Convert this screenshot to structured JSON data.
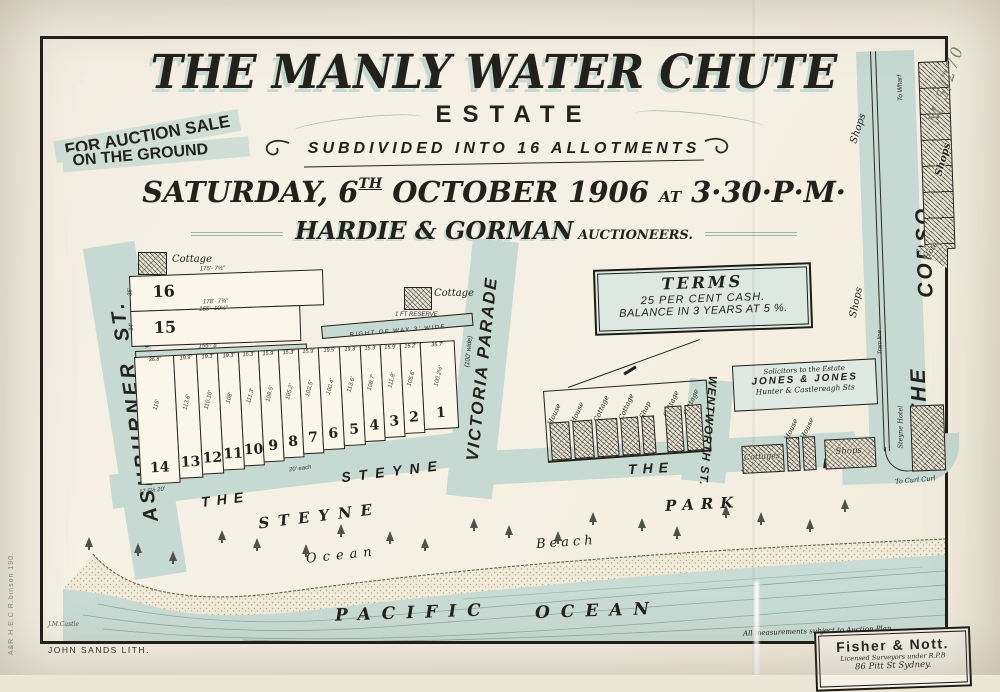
{
  "header": {
    "ribbon": [
      "FOR AUCTION SALE",
      "ON THE GROUND"
    ],
    "title": "THE MANLY WATER CHUTE",
    "estate": "ESTATE",
    "subdivided": "SUBDIVIDED INTO 16 ALLOTMENTS",
    "date_pre": "SATURDAY, 6",
    "date_sup": "TH",
    "date_mid": " OCTOBER 1906 ",
    "date_at": "AT",
    "date_time": " 3·30·P·M·",
    "auctioneers": "HARDIE & GORMAN",
    "auctioneers_title": " AUCTIONEERS."
  },
  "terms": {
    "heading": "TERMS",
    "line1": "25 PER CENT CASH.",
    "line2": "BALANCE IN 3 YEARS AT 5 %."
  },
  "solicitors": {
    "line1": "Solicitors to the Estate",
    "line2": "JONES & JONES",
    "line3": "Hunter & Castlereagh Sts"
  },
  "surveyors": {
    "name": "Fisher & Nott.",
    "line2": "Licensed Surveyors under R.P.B",
    "line3": "86 Pitt St Sydney."
  },
  "notes": {
    "measurements": "All measurements subject to Auction Plan.",
    "lith": "JOHN SANDS LITH.",
    "stamp": "A&R  H.E.C R.binson  190.",
    "catalog": "M 5/270",
    "signature": "J.M.Castle"
  },
  "map": {
    "ashburner": {
      "name": "ASHBURNER",
      "suffix": "ST.",
      "width": "(66' wide)"
    },
    "victoria": {
      "name": "VICTORIA PARADE",
      "width": "(100' wide)"
    },
    "wentworth": {
      "name": "WENTWORTH ST."
    },
    "corso": {
      "the": "THE",
      "name": "CORSO",
      "tram": "Tram line",
      "to_wharf": "To Wharf",
      "to_curl": "To Curl Curl",
      "shops_upper": "Shops",
      "shops_lower": "Shops",
      "shops_inner": "Shops",
      "hotel": "Hotel",
      "steyne_hotel": "Steyne Hotel"
    },
    "steyne_left": {
      "the": "THE",
      "name": "STEYNE"
    },
    "steyne_right": {
      "the": "THE",
      "name": "STEYNE"
    },
    "park": {
      "w1": "STEYNE",
      "w2": "PARK"
    },
    "shore": {
      "ocean": "Ocean",
      "beach": "Beach",
      "pacific": "PACIFIC",
      "ocean2": "OCEAN"
    },
    "row10": "RIGHT OF WAY 10' WIDE",
    "row3": "RIGHT OF WAY 3' WIDE",
    "reserve": "1 FT RESERVE",
    "cottage1": "Cottage",
    "cottage2": "Cottage",
    "lot16": {
      "n": "16",
      "side": "35'",
      "top": "175'· 7½\"",
      "mid": "178'· 7¾\""
    },
    "lot15": {
      "n": "15",
      "side": "34'",
      "top": "155'· 10¼\"",
      "bottom": "155'· 8\""
    },
    "lots": [
      {
        "n": "14",
        "w": "36.8'",
        "d": "115'"
      },
      {
        "n": "13",
        "w": "19.9'",
        "d": "113.6'"
      },
      {
        "n": "12",
        "w": "19.3'",
        "d": "110.10'"
      },
      {
        "n": "11",
        "w": "19.3'",
        "d": "108'"
      },
      {
        "n": "10",
        "w": "15.3'",
        "d": "111.3'"
      },
      {
        "n": "9",
        "w": "15.9'",
        "d": "108.5'"
      },
      {
        "n": "8",
        "w": "15.3'",
        "d": "105.2'"
      },
      {
        "n": "7",
        "w": "15.9'",
        "d": "103.5'"
      },
      {
        "n": "6",
        "w": "19.5'",
        "d": "100.4'"
      },
      {
        "n": "5",
        "w": "19.3'",
        "d": "113.6'"
      },
      {
        "n": "4",
        "w": "15.3'",
        "d": "108.7'"
      },
      {
        "n": "3",
        "w": "15.9'",
        "d": "111.8'"
      },
      {
        "n": "2",
        "w": "15.2'",
        "d": "105.6'"
      },
      {
        "n": "1",
        "w": "35.7'",
        "d": "100.2½'"
      }
    ],
    "lot_notes": {
      "left": "17.6½  20'",
      "right": "20' each"
    },
    "buildings_left": [
      "House",
      "House",
      "Cottage",
      "Cottage",
      "Shop",
      "Cottage",
      "Cottage"
    ],
    "buildings_right": {
      "cottages": "Cottages",
      "h1": "House",
      "h2": "House",
      "shops": "Shops"
    }
  }
}
